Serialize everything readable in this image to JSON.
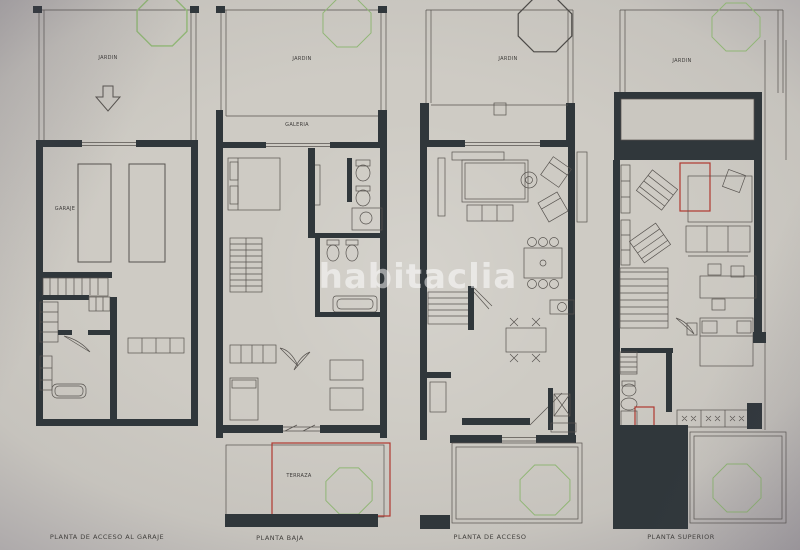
{
  "colors": {
    "wall": "#30373b",
    "line": "#57534f",
    "green": "#90b675",
    "tree_dark": "#4c4a47",
    "red": "#b03830",
    "paper": "#cac7c0",
    "watermark": "rgba(255,255,255,0.52)"
  },
  "watermark": {
    "text": "habitaclia"
  },
  "plans": [
    {
      "caption": "PLANTA DE ACCESO AL GARAJE",
      "labels": {
        "jardin": "JARDIN",
        "garaje": "GARAJE"
      }
    },
    {
      "caption": "PLANTA BAJA",
      "labels": {
        "jardin": "JARDIN",
        "galeria": "GALERIA",
        "terraza": "TERRAZA"
      }
    },
    {
      "caption": "PLANTA DE ACCESO",
      "labels": {
        "jardin": "JARDIN"
      }
    },
    {
      "caption": "PLANTA SUPERIOR",
      "labels": {
        "jardin": "JARDIN"
      }
    }
  ]
}
